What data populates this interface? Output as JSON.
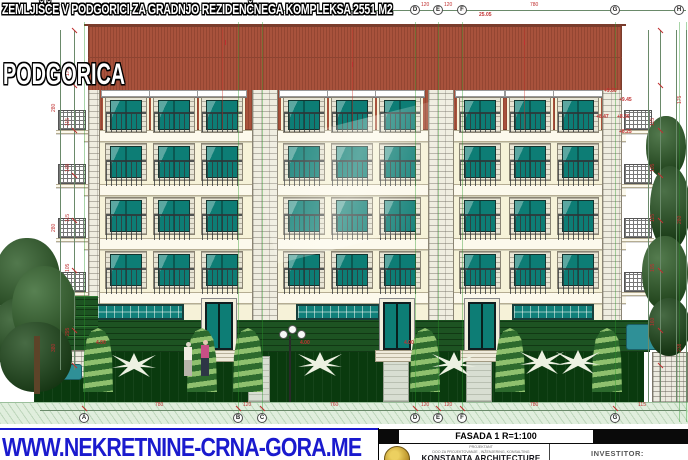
{
  "overlay": {
    "headline": "ZEMLJIŠČE V PODGORICI ZA GRADNJO REZIDENČNEGA KOMPLEKSA 2551 M2",
    "city": "PODGORICA",
    "website": "WWW.NEKRETNINE-CRNA-GORA.ME"
  },
  "titleblock": {
    "drawing_title": "FASADA 1 R=1:100",
    "projektant_line1": "PROJEKTANT",
    "projektant_line2": "DOO ZA PROJEKTOVANJE , INŽENJERING, KONSALTING",
    "firm_name": "KONSTANTA ARCHITECTURE",
    "investor_label": "INVESTITOR:",
    "logo": "konstanta-gold-seal"
  },
  "drawing": {
    "grid_top": [
      {
        "label": "D",
        "x": 415
      },
      {
        "label": "E",
        "x": 438
      },
      {
        "label": "F",
        "x": 462
      },
      {
        "label": "G",
        "x": 615
      },
      {
        "label": "H",
        "x": 679
      }
    ],
    "grid_bottom": [
      {
        "label": "A",
        "x": 84
      },
      {
        "label": "B",
        "x": 238
      },
      {
        "label": "C",
        "x": 262
      },
      {
        "label": "D",
        "x": 415
      },
      {
        "label": "E",
        "x": 438
      },
      {
        "label": "F",
        "x": 462
      },
      {
        "label": "G",
        "x": 615
      }
    ],
    "dims_top": [
      {
        "t": "120",
        "x": 421
      },
      {
        "t": "120",
        "x": 444
      },
      {
        "t": "780",
        "x": 530
      }
    ],
    "dims_bottom": [
      {
        "t": "780",
        "x": 155
      },
      {
        "t": "120",
        "x": 243
      },
      {
        "t": "760",
        "x": 330
      },
      {
        "t": "120",
        "x": 421
      },
      {
        "t": "120",
        "x": 444
      },
      {
        "t": "780",
        "x": 530
      },
      {
        "t": "115",
        "x": 638
      }
    ],
    "dims_left_inner": [
      {
        "t": "175",
        "y": 52
      },
      {
        "t": "115",
        "y": 102
      },
      {
        "t": "105",
        "y": 148
      },
      {
        "t": "115",
        "y": 198
      },
      {
        "t": "105",
        "y": 248
      },
      {
        "t": "295",
        "y": 312
      }
    ],
    "dims_left_outer": [
      {
        "t": "280",
        "y": 88
      },
      {
        "t": "280",
        "y": 208
      },
      {
        "t": "380",
        "y": 328
      }
    ],
    "dims_right_inner": [
      {
        "t": "115",
        "y": 102
      },
      {
        "t": "105",
        "y": 148
      },
      {
        "t": "115",
        "y": 198
      },
      {
        "t": "105",
        "y": 248
      },
      {
        "t": "160",
        "y": 302
      }
    ],
    "dims_right_outer": [
      {
        "t": "175",
        "y": 80
      },
      {
        "t": "280",
        "y": 200
      },
      {
        "t": "238",
        "y": 328
      }
    ],
    "elevation_marks": [
      {
        "t": "+9.60",
        "x": 604,
        "y": 89
      },
      {
        "t": "+9.45",
        "x": 619,
        "y": 98
      },
      {
        "t": "+8.47",
        "x": 596,
        "y": 115
      },
      {
        "t": "+8.36",
        "x": 617,
        "y": 115
      },
      {
        "t": "+8.25",
        "x": 619,
        "y": 130
      },
      {
        "t": "25.05",
        "x": 479,
        "y": 13
      },
      {
        "t": "4.00",
        "x": 96,
        "y": 341
      },
      {
        "t": "4.00",
        "x": 300,
        "y": 341
      },
      {
        "t": "4.00",
        "x": 404,
        "y": 341
      }
    ],
    "colors": {
      "roof": "#a8523c",
      "wall": "#f6f2d8",
      "window_glass": "#0d7d75",
      "hedge": "#1d5322",
      "lawn": "#0a3a0e",
      "annotation_red": "#c03030",
      "grid_green": "#2c962c",
      "website_blue": "#1a1ace"
    }
  }
}
